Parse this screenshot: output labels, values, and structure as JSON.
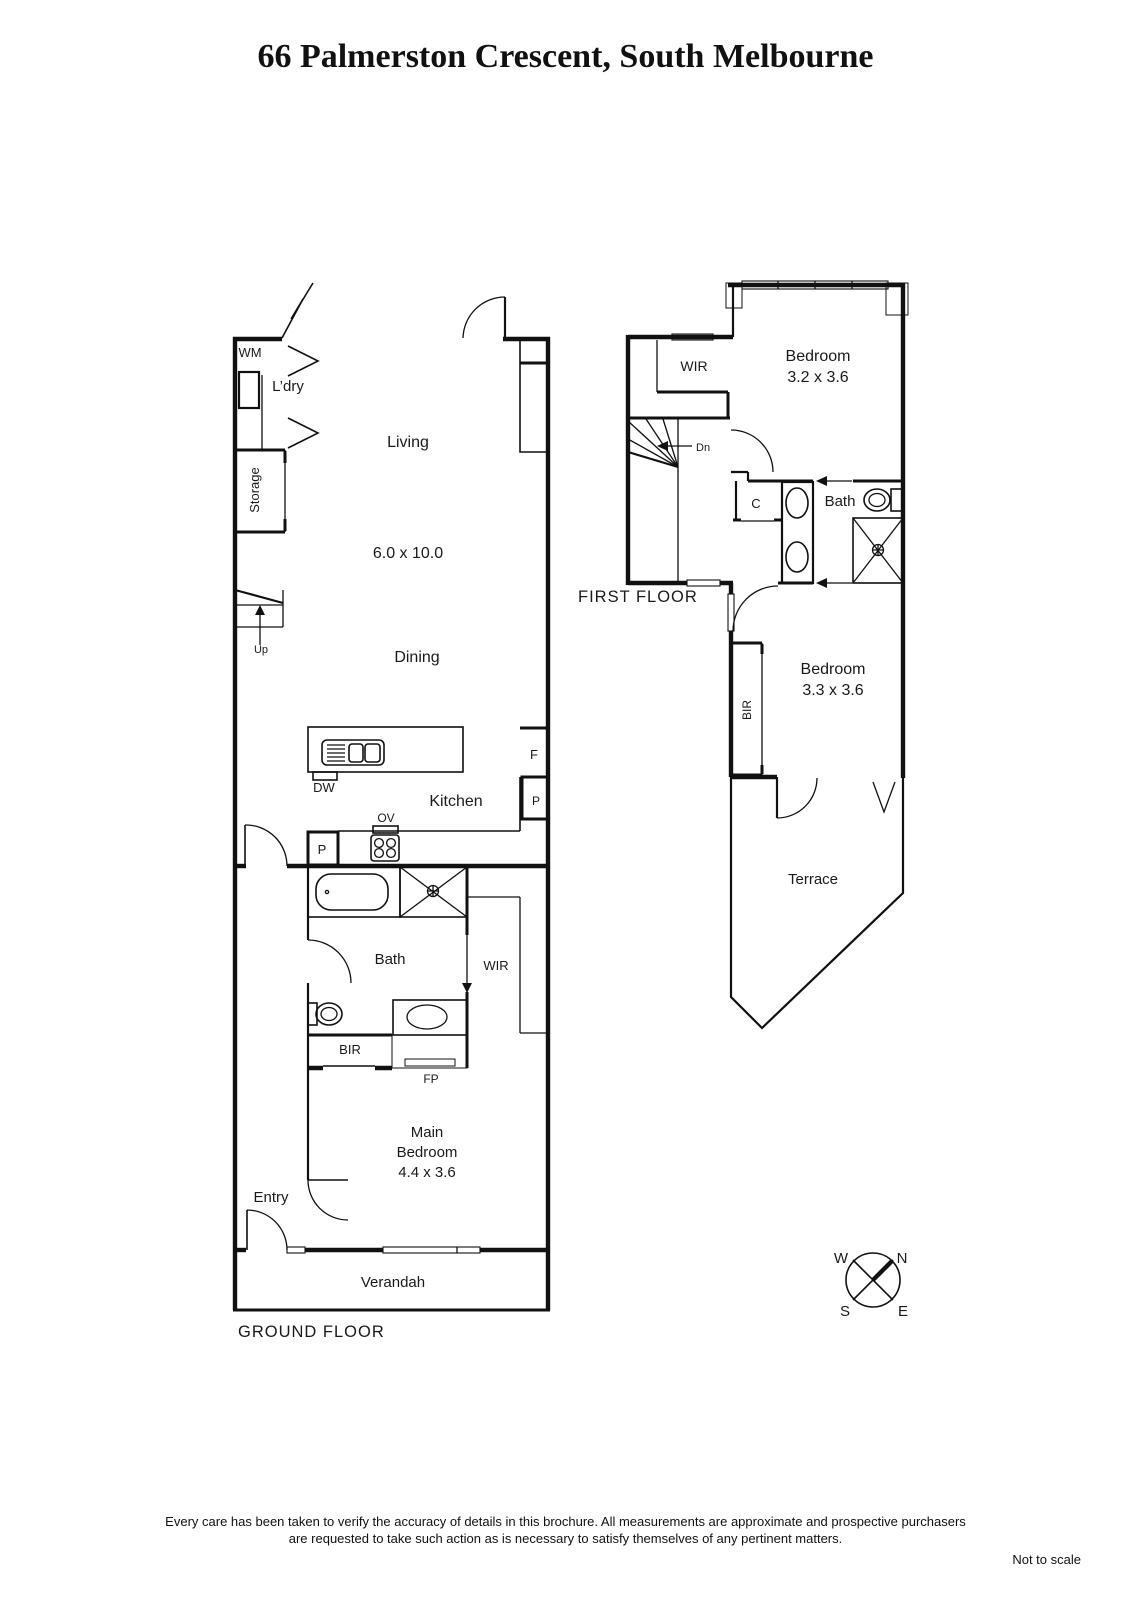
{
  "title": "66 Palmerston Crescent, South Melbourne",
  "ground_floor": {
    "floor_label": "GROUND FLOOR",
    "living": "Living",
    "living_dims": "6.0 x 10.0",
    "dining": "Dining",
    "kitchen": "Kitchen",
    "bath": "Bath",
    "entry": "Entry",
    "verandah": "Verandah",
    "laundry": "L’dry",
    "storage": "Storage",
    "main_bedroom_line1": "Main",
    "main_bedroom_line2": "Bedroom",
    "main_bedroom_dims": "4.4 x 3.6",
    "wm": "WM",
    "up": "Up",
    "dw": "DW",
    "ov": "OV",
    "pantry_left": "P",
    "pantry_right": "P",
    "fridge": "F",
    "wir": "WIR",
    "bir": "BIR",
    "fp": "FP"
  },
  "first_floor": {
    "floor_label": "FIRST FLOOR",
    "bedroom1": "Bedroom",
    "bedroom1_dims": "3.2 x 3.6",
    "bedroom2": "Bedroom",
    "bedroom2_dims": "3.3 x 3.6",
    "bath": "Bath",
    "terrace": "Terrace",
    "wir": "WIR",
    "dn": "Dn",
    "closet": "C",
    "bir": "BIR"
  },
  "compass": {
    "north": "N",
    "south": "S",
    "east": "E",
    "west": "W"
  },
  "footer": {
    "line1": "Every care has been taken to verify the accuracy of details in this brochure.  All measurements are approximate and prospective purchasers",
    "line2": "are requested to take such action as is necessary to satisfy themselves of any pertinent matters.",
    "scale_note": "Not to scale"
  }
}
